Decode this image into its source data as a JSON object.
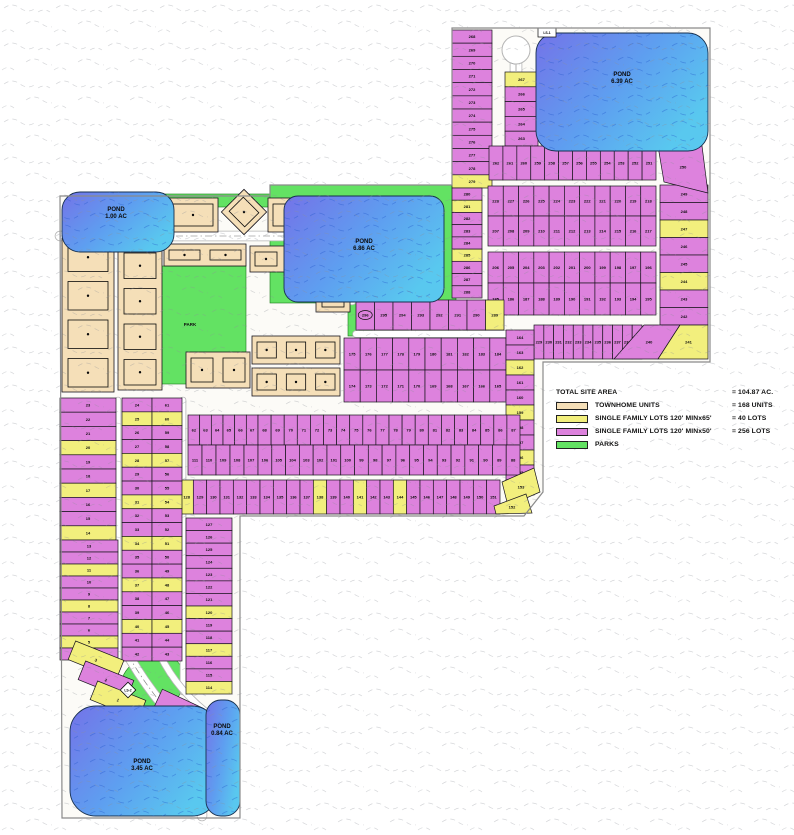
{
  "legend": {
    "title": "TOTAL SITE AREA",
    "title_value": "= 104.87 AC.",
    "items": [
      {
        "swatch": "townhome",
        "label": "TOWNHOME UNITS",
        "value": "= 168 UNITS"
      },
      {
        "swatch": "single_family_65",
        "label": "SINGLE FAMILY LOTS 120' MINx65'",
        "value": "= 40 LOTS"
      },
      {
        "swatch": "single_family_50",
        "label": "SINGLE FAMILY LOTS 120' MINx50'",
        "value": "= 256 LOTS"
      },
      {
        "swatch": "park",
        "label": "PARKS",
        "value": ""
      }
    ]
  },
  "colors": {
    "single_family_50": "#dd82dd",
    "single_family_65": "#f2ef7d",
    "townhome": "#f5dfb8",
    "park": "#63e263",
    "pond_dark": "#7473e8",
    "pond_light": "#59c8ef",
    "road": "#ffffff",
    "outline": "#17141c",
    "boundary": "#8a8a8a"
  },
  "ponds": [
    {
      "name": "pond-639",
      "x": 536,
      "y": 33,
      "w": 172,
      "h": 118,
      "r": 20,
      "l1": "POND",
      "l2": "6.39 AC",
      "lx": 622,
      "ly": 76
    },
    {
      "name": "pond-686",
      "x": 284,
      "y": 196,
      "w": 160,
      "h": 106,
      "r": 14,
      "l1": "POND",
      "l2": "6.86 AC",
      "lx": 364,
      "ly": 243
    },
    {
      "name": "pond-100",
      "x": 62,
      "y": 192,
      "w": 112,
      "h": 60,
      "r": 18,
      "l1": "POND",
      "l2": "1.00 AC",
      "lx": 116,
      "ly": 211
    },
    {
      "name": "pond-345",
      "x": 70,
      "y": 706,
      "w": 148,
      "h": 110,
      "r": 26,
      "l1": "POND",
      "l2": "3.45 AC",
      "lx": 142,
      "ly": 763
    },
    {
      "name": "pond-084",
      "x": 206,
      "y": 700,
      "w": 34,
      "h": 116,
      "r": 15,
      "l1": "POND",
      "l2": "0.84 AC",
      "lx": 222,
      "ly": 728
    }
  ],
  "parks": [
    {
      "type": "rect",
      "name": "park-north-strip",
      "x": 150,
      "y": 194,
      "w": 120,
      "h": 13
    },
    {
      "type": "rect",
      "name": "park-around-pond",
      "x": 270,
      "y": 185,
      "w": 186,
      "h": 118
    },
    {
      "type": "rect",
      "name": "park-wedge",
      "x": 348,
      "y": 296,
      "w": 24,
      "h": 40
    },
    {
      "type": "rect",
      "name": "park-central",
      "x": 134,
      "y": 266,
      "w": 112,
      "h": 118,
      "label": "PARK",
      "lx": 190,
      "ly": 326
    },
    {
      "type": "ellipse",
      "name": "park-south",
      "cx": 152,
      "cy": 684,
      "rx": 34,
      "ry": 28,
      "rot": -35
    }
  ],
  "markers": [
    {
      "type": "diamond",
      "label": "LS-2",
      "x": 128,
      "y": 690,
      "s": 11
    },
    {
      "type": "box",
      "label": "LS-1",
      "x": 538,
      "y": 28,
      "w": 18,
      "h": 9
    }
  ],
  "townhome_blocks": [
    {
      "x": 168,
      "y": 198,
      "w": 50,
      "h": 34,
      "dir": "h",
      "units": 1
    },
    {
      "x": 228,
      "y": 196,
      "w": 32,
      "h": 32,
      "dir": "h",
      "units": 1,
      "rot": 45
    },
    {
      "x": 268,
      "y": 198,
      "w": 46,
      "h": 34,
      "dir": "h",
      "units": 1
    },
    {
      "x": 62,
      "y": 238,
      "w": 52,
      "h": 154,
      "dir": "v",
      "units": 4
    },
    {
      "x": 118,
      "y": 248,
      "w": 44,
      "h": 142,
      "dir": "v",
      "units": 4
    },
    {
      "x": 164,
      "y": 244,
      "w": 82,
      "h": 22,
      "dir": "h",
      "units": 2
    },
    {
      "x": 250,
      "y": 246,
      "w": 64,
      "h": 26,
      "dir": "h",
      "units": 2
    },
    {
      "x": 316,
      "y": 244,
      "w": 34,
      "h": 68,
      "dir": "v",
      "units": 2
    },
    {
      "x": 186,
      "y": 352,
      "w": 64,
      "h": 36,
      "dir": "h",
      "units": 2
    },
    {
      "x": 252,
      "y": 336,
      "w": 88,
      "h": 28,
      "dir": "h",
      "units": 3
    },
    {
      "x": 252,
      "y": 368,
      "w": 88,
      "h": 28,
      "dir": "h",
      "units": 3
    }
  ],
  "lot_blocks": [
    {
      "name": "col-268-279",
      "x": 452,
      "y": 30,
      "w": 40,
      "h": 158,
      "dir": "v",
      "lots": [
        268,
        269,
        270,
        271,
        272,
        273,
        274,
        275,
        276,
        277,
        278,
        279
      ],
      "yellow": [
        279
      ]
    },
    {
      "name": "col-280-288",
      "x": 452,
      "y": 188,
      "w": 30,
      "h": 110,
      "dir": "v",
      "lots": [
        280,
        281,
        282,
        283,
        284,
        285,
        286,
        287,
        288
      ],
      "yellow": [
        281,
        285
      ]
    },
    {
      "name": "col-263-267",
      "x": 505,
      "y": 72,
      "w": 33,
      "h": 74,
      "dir": "v",
      "lots": [
        267,
        266,
        265,
        264,
        263
      ],
      "yellow": [
        267
      ]
    },
    {
      "name": "row-251-262",
      "x": 489,
      "y": 146,
      "w": 167,
      "h": 34,
      "dir": "h",
      "lots": [
        262,
        261,
        260,
        259,
        258,
        257,
        256,
        255,
        254,
        253,
        252,
        251
      ]
    },
    {
      "name": "col-242-249",
      "x": 660,
      "y": 185,
      "w": 48,
      "h": 140,
      "dir": "v",
      "lots": [
        249,
        248,
        247,
        246,
        245,
        244,
        243,
        242
      ],
      "yellow": [
        247,
        244
      ]
    },
    {
      "name": "row-218-228",
      "x": 488,
      "y": 186,
      "w": 168,
      "h": 30,
      "dir": "h",
      "lots": [
        228,
        227,
        226,
        225,
        224,
        223,
        222,
        221,
        220,
        219,
        218
      ]
    },
    {
      "name": "row-207-217",
      "x": 488,
      "y": 216,
      "w": 168,
      "h": 30,
      "dir": "h",
      "lots": [
        207,
        208,
        209,
        210,
        211,
        212,
        213,
        214,
        215,
        216,
        217
      ]
    },
    {
      "name": "row-196-206",
      "x": 488,
      "y": 252,
      "w": 168,
      "h": 31,
      "dir": "h",
      "lots": [
        206,
        205,
        204,
        203,
        202,
        201,
        200,
        199,
        198,
        197,
        196
      ]
    },
    {
      "name": "row-185-195",
      "x": 488,
      "y": 283,
      "w": 168,
      "h": 32,
      "dir": "h",
      "lots": [
        185,
        186,
        187,
        188,
        189,
        190,
        191,
        192,
        193,
        194,
        195
      ]
    },
    {
      "name": "row-229-239",
      "x": 534,
      "y": 325,
      "w": 108,
      "h": 34,
      "dir": "h",
      "lots": [
        229,
        230,
        231,
        232,
        233,
        234,
        235,
        236,
        237,
        238,
        239
      ]
    },
    {
      "name": "row-289-296",
      "x": 356,
      "y": 300,
      "w": 148,
      "h": 30,
      "dir": "h",
      "lots": [
        296,
        295,
        294,
        293,
        292,
        291,
        290,
        289
      ],
      "yellow": [
        289
      ],
      "circled": [
        296
      ]
    },
    {
      "name": "row-175-184",
      "x": 344,
      "y": 338,
      "w": 162,
      "h": 32,
      "dir": "h",
      "lots": [
        175,
        176,
        177,
        178,
        179,
        180,
        181,
        182,
        183,
        184
      ]
    },
    {
      "name": "row-165-174",
      "x": 344,
      "y": 370,
      "w": 162,
      "h": 32,
      "dir": "h",
      "lots": [
        174,
        173,
        172,
        171,
        170,
        169,
        168,
        167,
        166,
        165
      ]
    },
    {
      "name": "col-154-164",
      "x": 506,
      "y": 330,
      "w": 28,
      "h": 165,
      "dir": "v",
      "lots": [
        164,
        163,
        162,
        161,
        160,
        159,
        158,
        157,
        156,
        155,
        154
      ],
      "yellow": [
        162,
        159,
        156
      ]
    },
    {
      "name": "row-62-67",
      "x": 188,
      "y": 415,
      "w": 70,
      "h": 30,
      "dir": "h",
      "lots": [
        62,
        63,
        64,
        65,
        66,
        67
      ]
    },
    {
      "name": "row-68-87",
      "x": 258,
      "y": 415,
      "w": 262,
      "h": 30,
      "dir": "h",
      "lots": [
        68,
        69,
        70,
        71,
        72,
        73,
        74,
        75,
        76,
        77,
        78,
        79,
        80,
        81,
        82,
        83,
        84,
        85,
        86,
        87
      ]
    },
    {
      "name": "row-107-111",
      "x": 188,
      "y": 445,
      "w": 70,
      "h": 30,
      "dir": "h",
      "lots": [
        111,
        110,
        109,
        108,
        107
      ]
    },
    {
      "name": "row-88-106",
      "x": 258,
      "y": 445,
      "w": 262,
      "h": 30,
      "dir": "h",
      "lots": [
        106,
        105,
        104,
        103,
        102,
        101,
        100,
        99,
        98,
        97,
        96,
        95,
        94,
        93,
        92,
        91,
        90,
        89,
        88
      ]
    },
    {
      "name": "row-128-151",
      "x": 180,
      "y": 480,
      "w": 320,
      "h": 34,
      "dir": "h",
      "lots": [
        128,
        129,
        130,
        131,
        132,
        133,
        134,
        135,
        136,
        137,
        138,
        139,
        140,
        141,
        142,
        143,
        144,
        145,
        146,
        147,
        148,
        149,
        150,
        151
      ],
      "yellow": [
        128,
        138,
        141,
        144
      ]
    },
    {
      "name": "col-14-23",
      "x": 60,
      "y": 398,
      "w": 56,
      "h": 142,
      "dir": "v",
      "lots": [
        23,
        22,
        21,
        20,
        19,
        18,
        17,
        16,
        15,
        14
      ],
      "yellow": [
        20,
        17,
        14
      ]
    },
    {
      "name": "col-4-13",
      "x": 60,
      "y": 540,
      "w": 58,
      "h": 120,
      "dir": "v",
      "lots": [
        13,
        12,
        11,
        10,
        9,
        8,
        7,
        6,
        5,
        4
      ],
      "yellow": [
        11,
        8,
        5
      ]
    },
    {
      "name": "col-24-42",
      "x": 122,
      "y": 398,
      "w": 30,
      "h": 263,
      "dir": "v",
      "lots": [
        24,
        25,
        26,
        27,
        28,
        29,
        30,
        31,
        32,
        33,
        34,
        35,
        36,
        37,
        38,
        39,
        40,
        41,
        42
      ],
      "yellow": [
        25,
        28,
        31,
        34,
        37,
        40
      ]
    },
    {
      "name": "col-43-61",
      "x": 152,
      "y": 398,
      "w": 30,
      "h": 263,
      "dir": "v",
      "lots": [
        61,
        60,
        59,
        58,
        57,
        56,
        55,
        54,
        53,
        52,
        51,
        50,
        49,
        48,
        47,
        46,
        45,
        44,
        43
      ],
      "yellow": [
        60,
        57,
        54,
        51,
        48,
        45
      ]
    },
    {
      "name": "col-114-127",
      "x": 186,
      "y": 518,
      "w": 46,
      "h": 176,
      "dir": "v",
      "lots": [
        127,
        126,
        125,
        124,
        123,
        122,
        121,
        120,
        119,
        118,
        117,
        116,
        115,
        114
      ],
      "yellow": [
        120,
        117,
        114
      ]
    }
  ],
  "lot_polygons": [
    {
      "n": 250,
      "c": "p",
      "points": [
        [
          658,
          146
        ],
        [
          702,
          146
        ],
        [
          708,
          193
        ],
        [
          664,
          182
        ]
      ]
    },
    {
      "n": 240,
      "c": "p",
      "points": [
        [
          644,
          325
        ],
        [
          680,
          325
        ],
        [
          658,
          359
        ],
        [
          614,
          359
        ]
      ]
    },
    {
      "n": 241,
      "c": "y",
      "points": [
        [
          680,
          325
        ],
        [
          708,
          325
        ],
        [
          708,
          359
        ],
        [
          658,
          359
        ]
      ]
    },
    {
      "n": 153,
      "c": "y",
      "points": [
        [
          502,
          482
        ],
        [
          534,
          468
        ],
        [
          540,
          492
        ],
        [
          508,
          506
        ]
      ]
    },
    {
      "n": 152,
      "c": "y",
      "points": [
        [
          494,
          506
        ],
        [
          526,
          494
        ],
        [
          532,
          513
        ],
        [
          496,
          514
        ]
      ]
    }
  ],
  "lot_rot_rects": [
    {
      "n": 3,
      "c": "y",
      "x": 70,
      "y": 650,
      "w": 52,
      "h": 20,
      "rot": 22
    },
    {
      "n": 2,
      "c": "p",
      "x": 80,
      "y": 670,
      "w": 52,
      "h": 20,
      "rot": 22
    },
    {
      "n": 1,
      "c": "y",
      "x": 92,
      "y": 690,
      "w": 52,
      "h": 20,
      "rot": 22
    },
    {
      "n": 113,
      "c": "p",
      "x": 156,
      "y": 698,
      "w": 46,
      "h": 20,
      "rot": 25
    },
    {
      "n": 112,
      "c": "p",
      "x": 146,
      "y": 718,
      "w": 46,
      "h": 20,
      "rot": 25
    }
  ]
}
